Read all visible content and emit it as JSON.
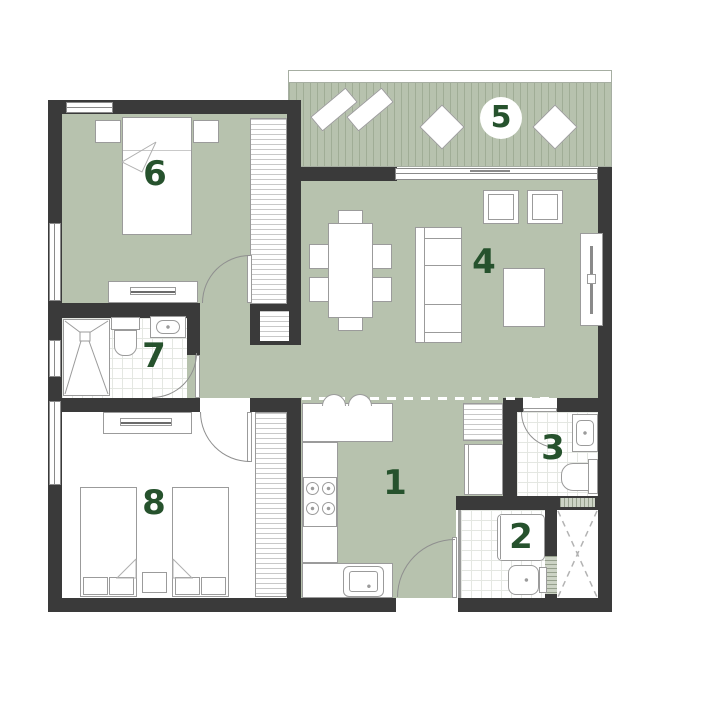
{
  "title": "apartment-floor-plan",
  "colors": {
    "background": "#ffffff",
    "floor": "#b7c2ae",
    "wall": "#3a3a3a",
    "room_number": "#26522d",
    "deck_stripe": "#a0ad96",
    "furniture_outline": "#9b9b9b"
  },
  "rooms": [
    {
      "number": "1",
      "name": "kitchen-hall"
    },
    {
      "number": "2",
      "name": "wc-laundry"
    },
    {
      "number": "3",
      "name": "bathroom"
    },
    {
      "number": "4",
      "name": "living-room"
    },
    {
      "number": "5",
      "name": "balcony"
    },
    {
      "number": "6",
      "name": "bedroom"
    },
    {
      "number": "7",
      "name": "shower-room"
    },
    {
      "number": "8",
      "name": "twin-bedroom"
    }
  ]
}
